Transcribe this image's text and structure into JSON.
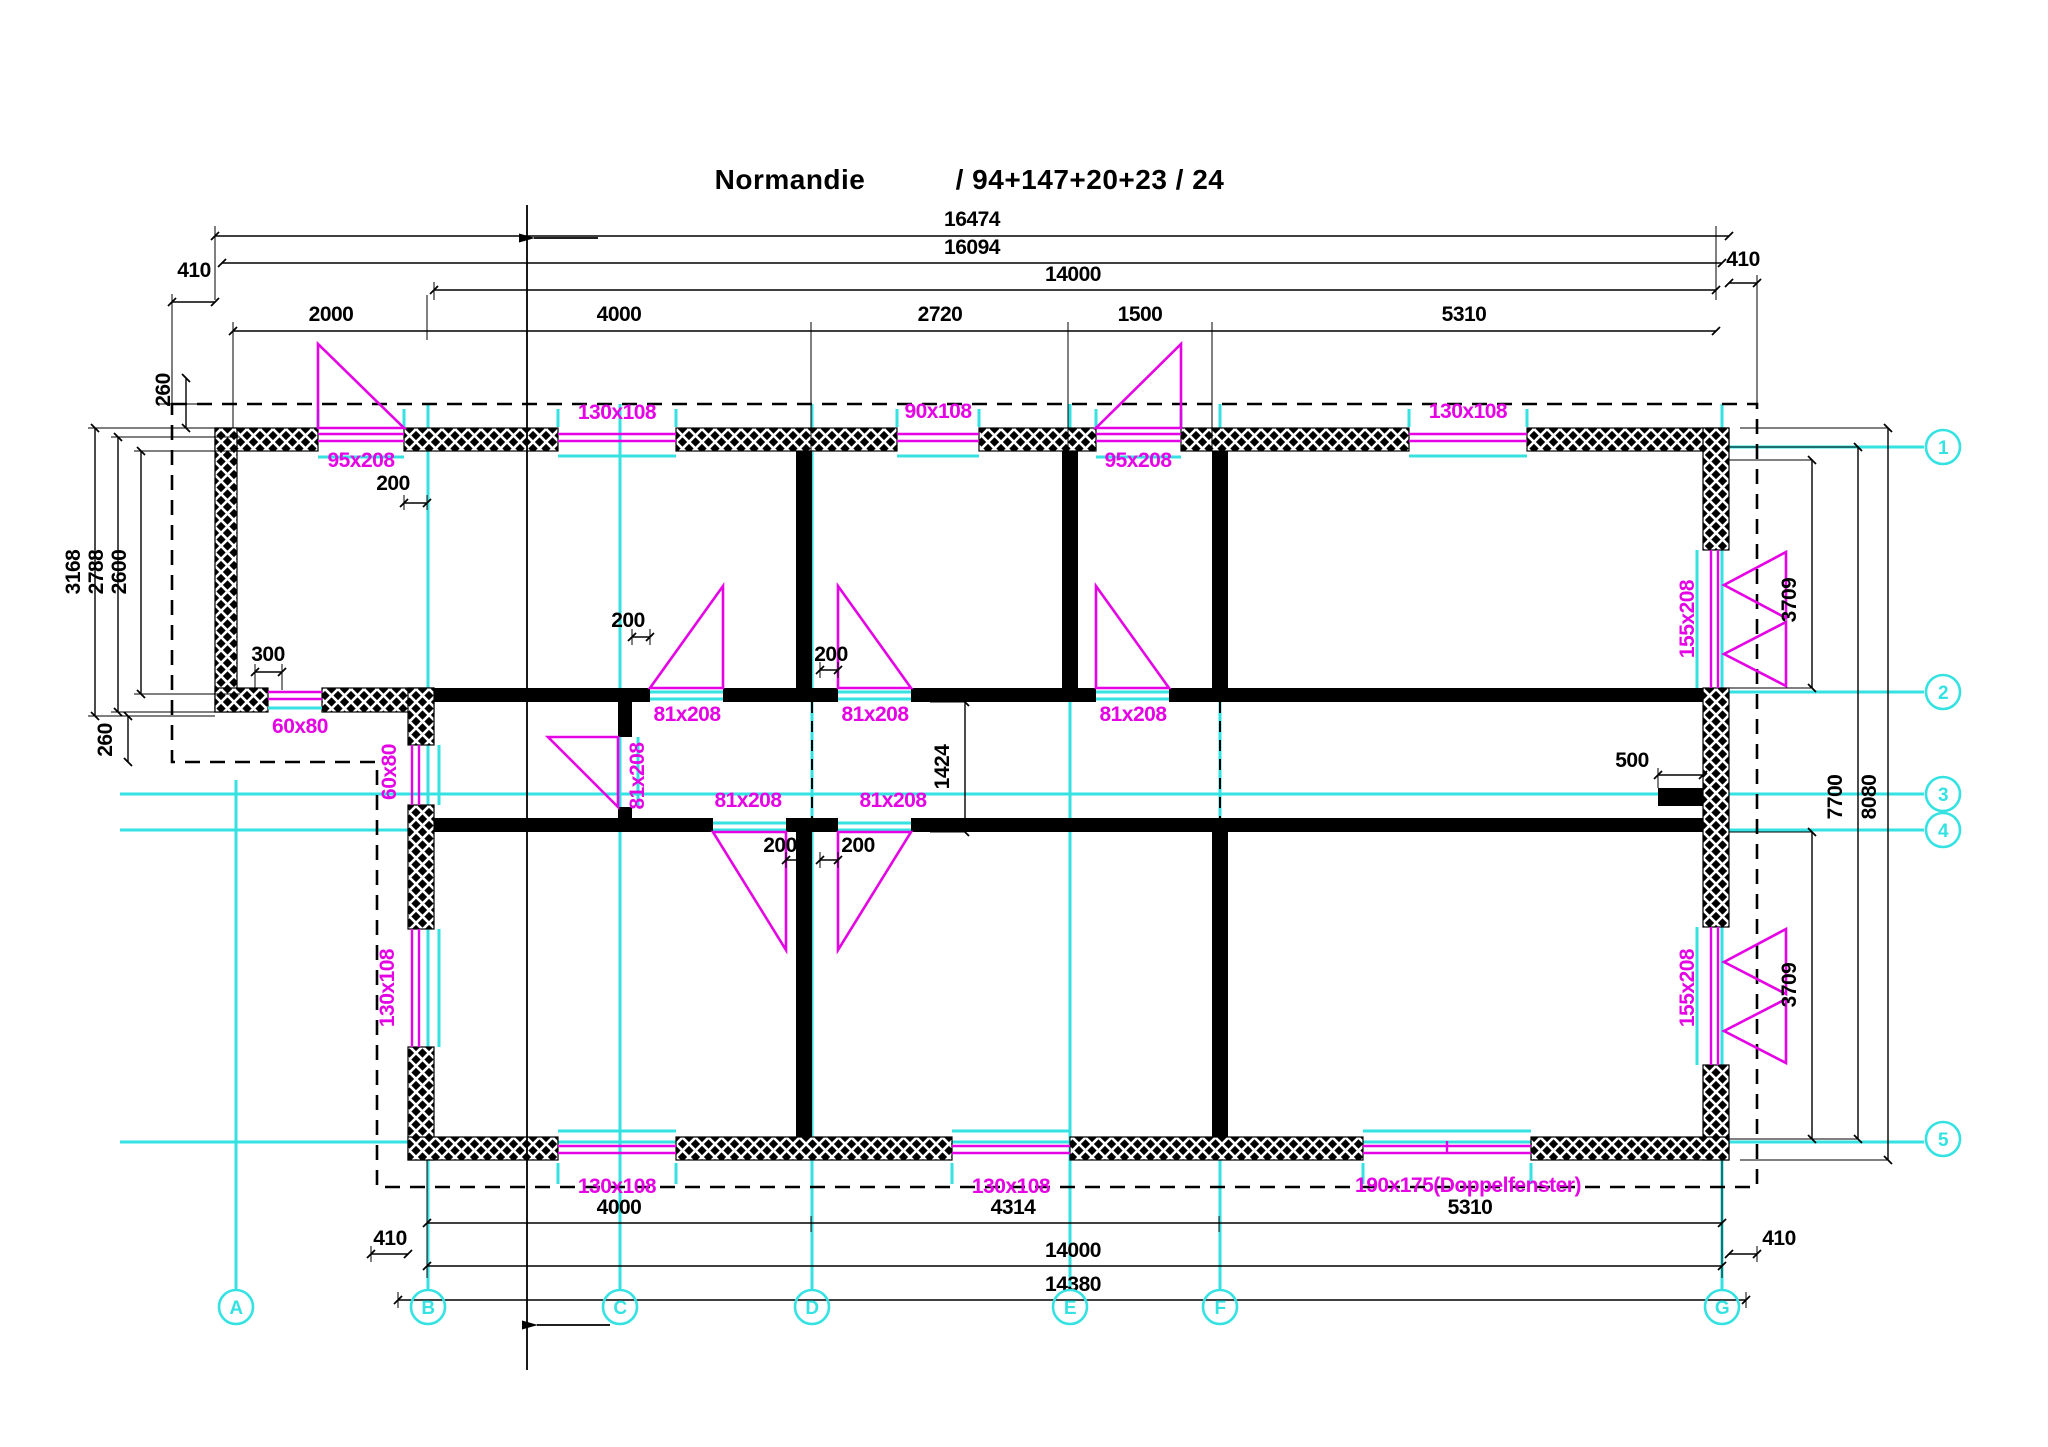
{
  "title": {
    "name": "Normandie",
    "code": "/ 94+147+20+23 / 24"
  },
  "colors": {
    "wall": "#000000",
    "opening": "#E503E5",
    "axis": "#35E2E2",
    "background": "#ffffff"
  },
  "grid_columns": [
    {
      "label": "A",
      "x": 236
    },
    {
      "label": "B",
      "x": 428
    },
    {
      "label": "C",
      "x": 620
    },
    {
      "label": "D",
      "x": 812
    },
    {
      "label": "E",
      "x": 1070
    },
    {
      "label": "F",
      "x": 1220
    },
    {
      "label": "G",
      "x": 1722
    }
  ],
  "grid_rows": [
    {
      "label": "1",
      "y": 447
    },
    {
      "label": "2",
      "y": 692
    },
    {
      "label": "3",
      "y": 794
    },
    {
      "label": "4",
      "y": 830
    },
    {
      "label": "5",
      "y": 1139
    }
  ],
  "labels": [
    {
      "t": "16474",
      "x": 972,
      "y": 226
    },
    {
      "t": "16094",
      "x": 972,
      "y": 254
    },
    {
      "t": "14000",
      "x": 1073,
      "y": 281
    },
    {
      "t": "410",
      "x": 194,
      "y": 277
    },
    {
      "t": "410",
      "x": 1743,
      "y": 266
    },
    {
      "t": "2000",
      "x": 331,
      "y": 321
    },
    {
      "t": "4000",
      "x": 619,
      "y": 321
    },
    {
      "t": "2720",
      "x": 940,
      "y": 321
    },
    {
      "t": "1500",
      "x": 1140,
      "y": 321
    },
    {
      "t": "5310",
      "x": 1464,
      "y": 321
    },
    {
      "t": "260",
      "x": 170,
      "y": 390,
      "r": -90
    },
    {
      "t": "3168",
      "x": 80,
      "y": 572,
      "r": -90
    },
    {
      "t": "2788",
      "x": 103,
      "y": 572,
      "r": -90
    },
    {
      "t": "2600",
      "x": 126,
      "y": 572,
      "r": -90
    },
    {
      "t": "95x208",
      "x": 361,
      "y": 467,
      "c": "m"
    },
    {
      "t": "200",
      "x": 393,
      "y": 490
    },
    {
      "t": "130x108",
      "x": 617,
      "y": 419,
      "c": "m"
    },
    {
      "t": "90x108",
      "x": 938,
      "y": 418,
      "c": "m"
    },
    {
      "t": "95x208",
      "x": 1138,
      "y": 467,
      "c": "m"
    },
    {
      "t": "130x108",
      "x": 1468,
      "y": 418,
      "c": "m"
    },
    {
      "t": "155x208",
      "x": 1694,
      "y": 619,
      "r": -90,
      "c": "m"
    },
    {
      "t": "3709",
      "x": 1796,
      "y": 600,
      "r": -90
    },
    {
      "t": "300",
      "x": 268,
      "y": 661
    },
    {
      "t": "60x80",
      "x": 300,
      "y": 733,
      "c": "m"
    },
    {
      "t": "60x80",
      "x": 396,
      "y": 772,
      "r": -90,
      "c": "m"
    },
    {
      "t": "260",
      "x": 112,
      "y": 740,
      "r": -90
    },
    {
      "t": "200",
      "x": 628,
      "y": 627
    },
    {
      "t": "200",
      "x": 831,
      "y": 661
    },
    {
      "t": "81x208",
      "x": 687,
      "y": 721,
      "c": "m"
    },
    {
      "t": "81x208",
      "x": 875,
      "y": 721,
      "c": "m"
    },
    {
      "t": "81x208",
      "x": 1133,
      "y": 721,
      "c": "m"
    },
    {
      "t": "81x208",
      "x": 644,
      "y": 776,
      "r": -90,
      "c": "m"
    },
    {
      "t": "1424",
      "x": 949,
      "y": 767,
      "r": -90
    },
    {
      "t": "500",
      "x": 1632,
      "y": 767
    },
    {
      "t": "81x208",
      "x": 748,
      "y": 807,
      "c": "m"
    },
    {
      "t": "81x208",
      "x": 893,
      "y": 807,
      "c": "m"
    },
    {
      "t": "200",
      "x": 780,
      "y": 852
    },
    {
      "t": "200",
      "x": 858,
      "y": 852
    },
    {
      "t": "155x208",
      "x": 1694,
      "y": 988,
      "r": -90,
      "c": "m"
    },
    {
      "t": "3709",
      "x": 1796,
      "y": 985,
      "r": -90
    },
    {
      "t": "7700",
      "x": 1842,
      "y": 797,
      "r": -90
    },
    {
      "t": "8080",
      "x": 1876,
      "y": 797,
      "r": -90
    },
    {
      "t": "130x108",
      "x": 394,
      "y": 988,
      "r": -90,
      "c": "m"
    },
    {
      "t": "130x108",
      "x": 617,
      "y": 1193,
      "c": "m"
    },
    {
      "t": "130x108",
      "x": 1011,
      "y": 1193,
      "c": "m"
    },
    {
      "t": "190x175(Doppelfenster)",
      "x": 1468,
      "y": 1192,
      "c": "m"
    },
    {
      "t": "4000",
      "x": 619,
      "y": 1214
    },
    {
      "t": "4314",
      "x": 1013,
      "y": 1214
    },
    {
      "t": "5310",
      "x": 1470,
      "y": 1214
    },
    {
      "t": "410",
      "x": 390,
      "y": 1245
    },
    {
      "t": "410",
      "x": 1779,
      "y": 1245
    },
    {
      "t": "14000",
      "x": 1073,
      "y": 1257
    },
    {
      "t": "14380",
      "x": 1073,
      "y": 1291
    }
  ]
}
